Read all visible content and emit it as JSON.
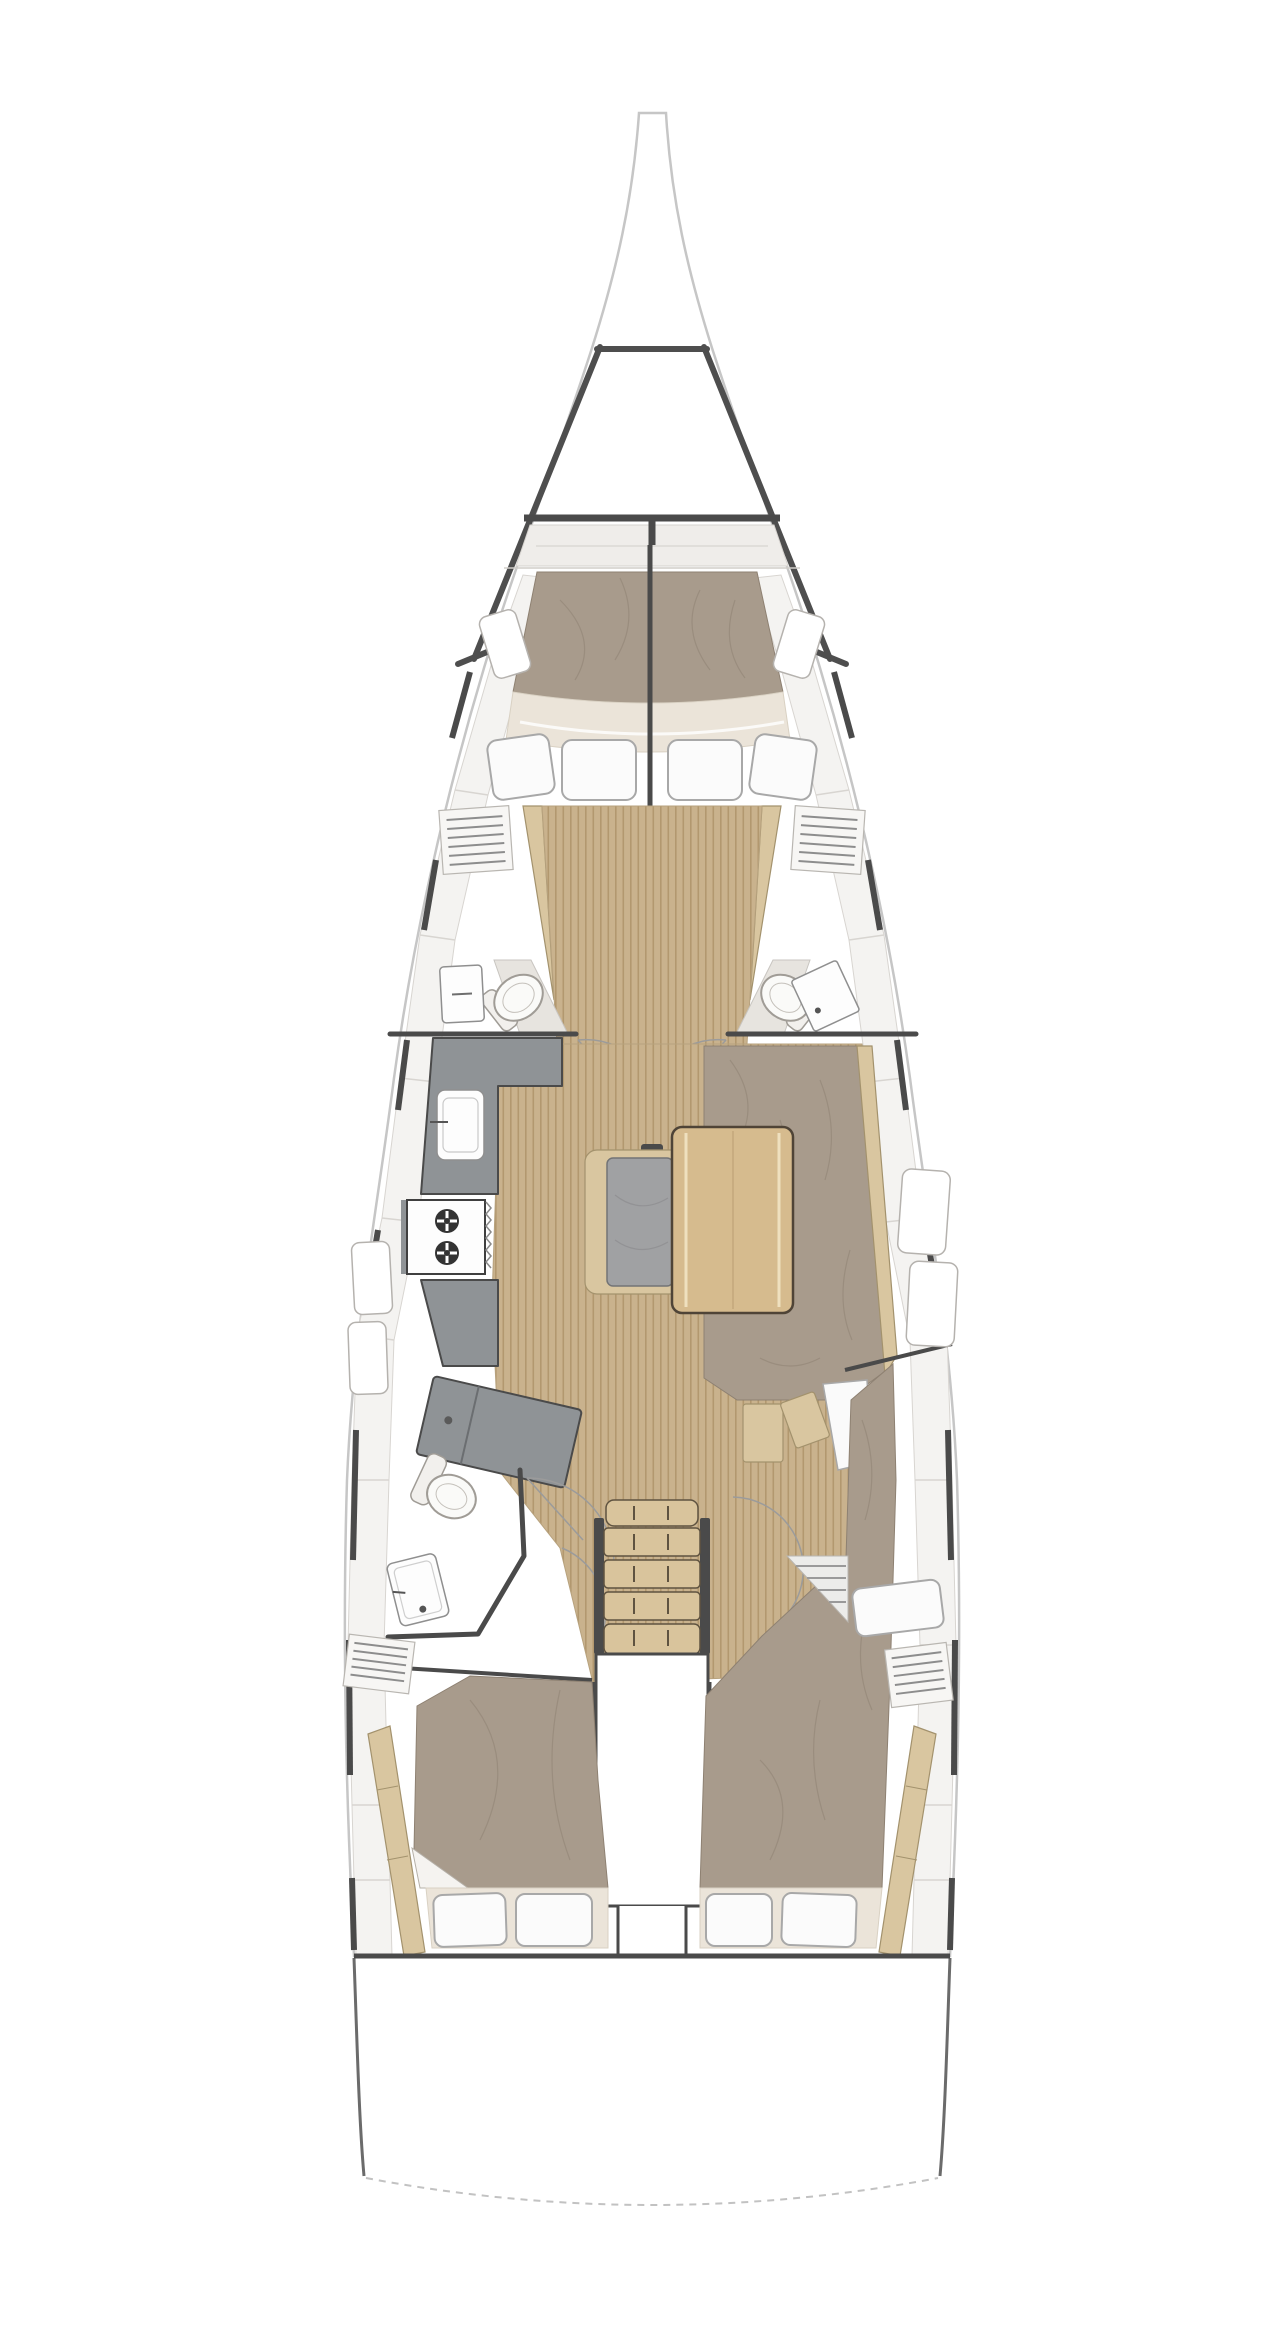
{
  "diagram": {
    "type": "floorplan",
    "subject": "sailing-yacht-interior-deck-plan",
    "orientation": "bow-up",
    "text_labels": [],
    "areas": [
      "bowsprit",
      "bow-pulpit",
      "forward-cabin-v-berth",
      "forward-head-port",
      "forward-head-starboard",
      "galley-port",
      "chart-table",
      "salon-table",
      "center-bench",
      "starboard-settee",
      "aft-head-port",
      "companionway-stairs",
      "engine-compartment",
      "aft-cabin-port",
      "aft-cabin-starboard",
      "transom"
    ],
    "counts": {
      "forward-berth-pillows": 4,
      "aft-cabin-pillows-per-cabin": 2,
      "stove-burners": 2,
      "companionway-treads": 5
    }
  },
  "palette": {
    "hull-line": "#c6c6c6",
    "dark": "#4a4a4a",
    "deck": "#f4f3f1",
    "deck-line": "#d8d5d1",
    "mattress": "#a89b8c",
    "mattress-line": "#8e8172",
    "cream": "#ebe4d9",
    "cream-line": "#d9d1c3",
    "pillow": "#fbfbfb",
    "pillow-line": "#a8a8a8",
    "wood": "#c9b28d",
    "wood-line": "#b2986f",
    "wood-trim": "#d9c6a0",
    "wood-trim-line": "#a3926d",
    "counter": "#8f9396",
    "cushion": "#a0a1a3",
    "fixture": "#fdfdfd",
    "fixture-line": "#8f8f8f",
    "thin": "#9b9b9b",
    "louver": "#8d8d8d",
    "table": "#d6bb8e",
    "table-line": "#4f4437",
    "tread": "#d9c49c",
    "tread-line": "#5f5340",
    "locker": "#e7e4df",
    "locker-line": "#c8c5c0"
  }
}
